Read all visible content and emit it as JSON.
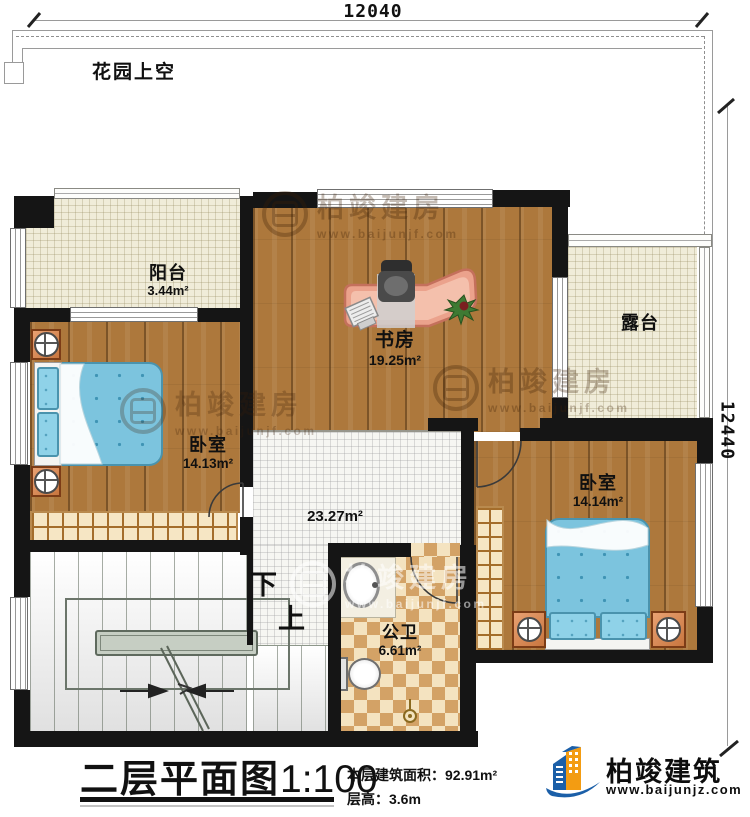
{
  "dimensions": {
    "top": "12040",
    "right": "12440"
  },
  "garden": {
    "label": "花园上空"
  },
  "rooms": {
    "balcony": {
      "name": "阳台",
      "area": "3.44m²"
    },
    "study": {
      "name": "书房",
      "area": "19.25m²"
    },
    "terrace": {
      "name": "露台"
    },
    "bedroom_left": {
      "name": "卧室",
      "area": "14.13m²"
    },
    "hall": {
      "area": "23.27m²"
    },
    "bathroom": {
      "name": "公卫",
      "area": "6.61m²"
    },
    "bedroom_right": {
      "name": "卧室",
      "area": "14.14m²"
    }
  },
  "stairs": {
    "down": "下",
    "up": "上"
  },
  "title_block": {
    "title": "二层平面图",
    "scale": "1:100",
    "area_label": "本层建筑面积：",
    "area_value": "92.91m²",
    "floor_height_label": "层高：",
    "floor_height_value": "3.6m"
  },
  "branding": {
    "company": "柏竣建筑",
    "website": "www.baijunjz.com"
  },
  "watermark": {
    "text": "柏竣建房",
    "url": "www.baijunjf.com"
  },
  "colors": {
    "wall": "#151515",
    "wood": "#ad783c",
    "bed": "#7cc4de",
    "accent_orange": "#f39c12",
    "accent_blue": "#1b5fa8"
  }
}
